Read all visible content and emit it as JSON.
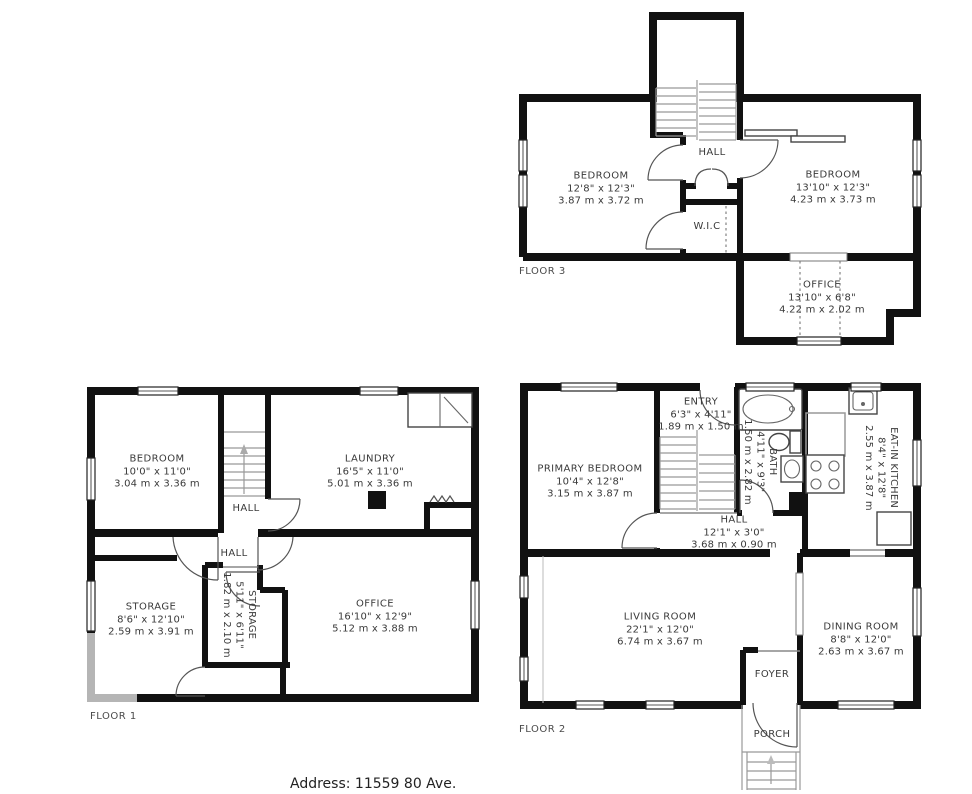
{
  "address_line": "Address: 11559 80 Ave.",
  "floor3": {
    "label": "FLOOR 3",
    "rooms": {
      "bedroom_left": {
        "name": "BEDROOM",
        "imperial": "12'8\" x 12'3\"",
        "metric": "3.87 m x 3.72 m"
      },
      "hall": {
        "name": "HALL"
      },
      "wic": {
        "name": "W.I.C"
      },
      "bedroom_right": {
        "name": "BEDROOM",
        "imperial": "13'10\" x 12'3\"",
        "metric": "4.23 m x 3.73 m"
      },
      "office": {
        "name": "OFFICE",
        "imperial": "13'10\" x 6'8\"",
        "metric": "4.22 m x 2.02 m"
      }
    }
  },
  "floor1": {
    "label": "FLOOR 1",
    "rooms": {
      "bedroom": {
        "name": "BEDROOM",
        "imperial": "10'0\" x 11'0\"",
        "metric": "3.04 m x 3.36 m"
      },
      "laundry": {
        "name": "LAUNDRY",
        "imperial": "16'5\" x 11'0\"",
        "metric": "5.01 m x 3.36 m"
      },
      "hall_upper": {
        "name": "HALL"
      },
      "hall_lower": {
        "name": "HALL"
      },
      "storage_large": {
        "name": "STORAGE",
        "imperial": "8'6\" x 12'10\"",
        "metric": "2.59 m x 3.91 m"
      },
      "storage_small": {
        "name": "STORAGE",
        "imperial": "5'11\" x 6'11\"",
        "metric": "1.82 m x 2.10 m"
      },
      "office": {
        "name": "OFFICE",
        "imperial": "16'10\" x 12'9\"",
        "metric": "5.12 m x 3.88 m"
      }
    }
  },
  "floor2": {
    "label": "FLOOR 2",
    "rooms": {
      "primary_bedroom": {
        "name": "PRIMARY BEDROOM",
        "imperial": "10'4\" x 12'8\"",
        "metric": "3.15 m x 3.87 m"
      },
      "entry": {
        "name": "ENTRY",
        "imperial": "6'3\" x 4'11\"",
        "metric": "1.89 m x 1.50 m"
      },
      "bath": {
        "name": "BATH",
        "imperial": "4'11\" x 9'3\"",
        "metric": "1.50 m x 2.82 m"
      },
      "kitchen": {
        "name": "EAT-IN KITCHEN",
        "imperial": "8'4\" x 12'8\"",
        "metric": "2.55 m x 3.87 m"
      },
      "hall": {
        "name": "HALL",
        "imperial": "12'1\" x 3'0\"",
        "metric": "3.68 m x 0.90 m"
      },
      "living": {
        "name": "LIVING ROOM",
        "imperial": "22'1\" x 12'0\"",
        "metric": "6.74 m x 3.67 m"
      },
      "dining": {
        "name": "DINING ROOM",
        "imperial": "8'8\" x 12'0\"",
        "metric": "2.63 m x 3.67 m"
      },
      "foyer": {
        "name": "FOYER"
      },
      "porch": {
        "name": "PORCH"
      }
    }
  }
}
